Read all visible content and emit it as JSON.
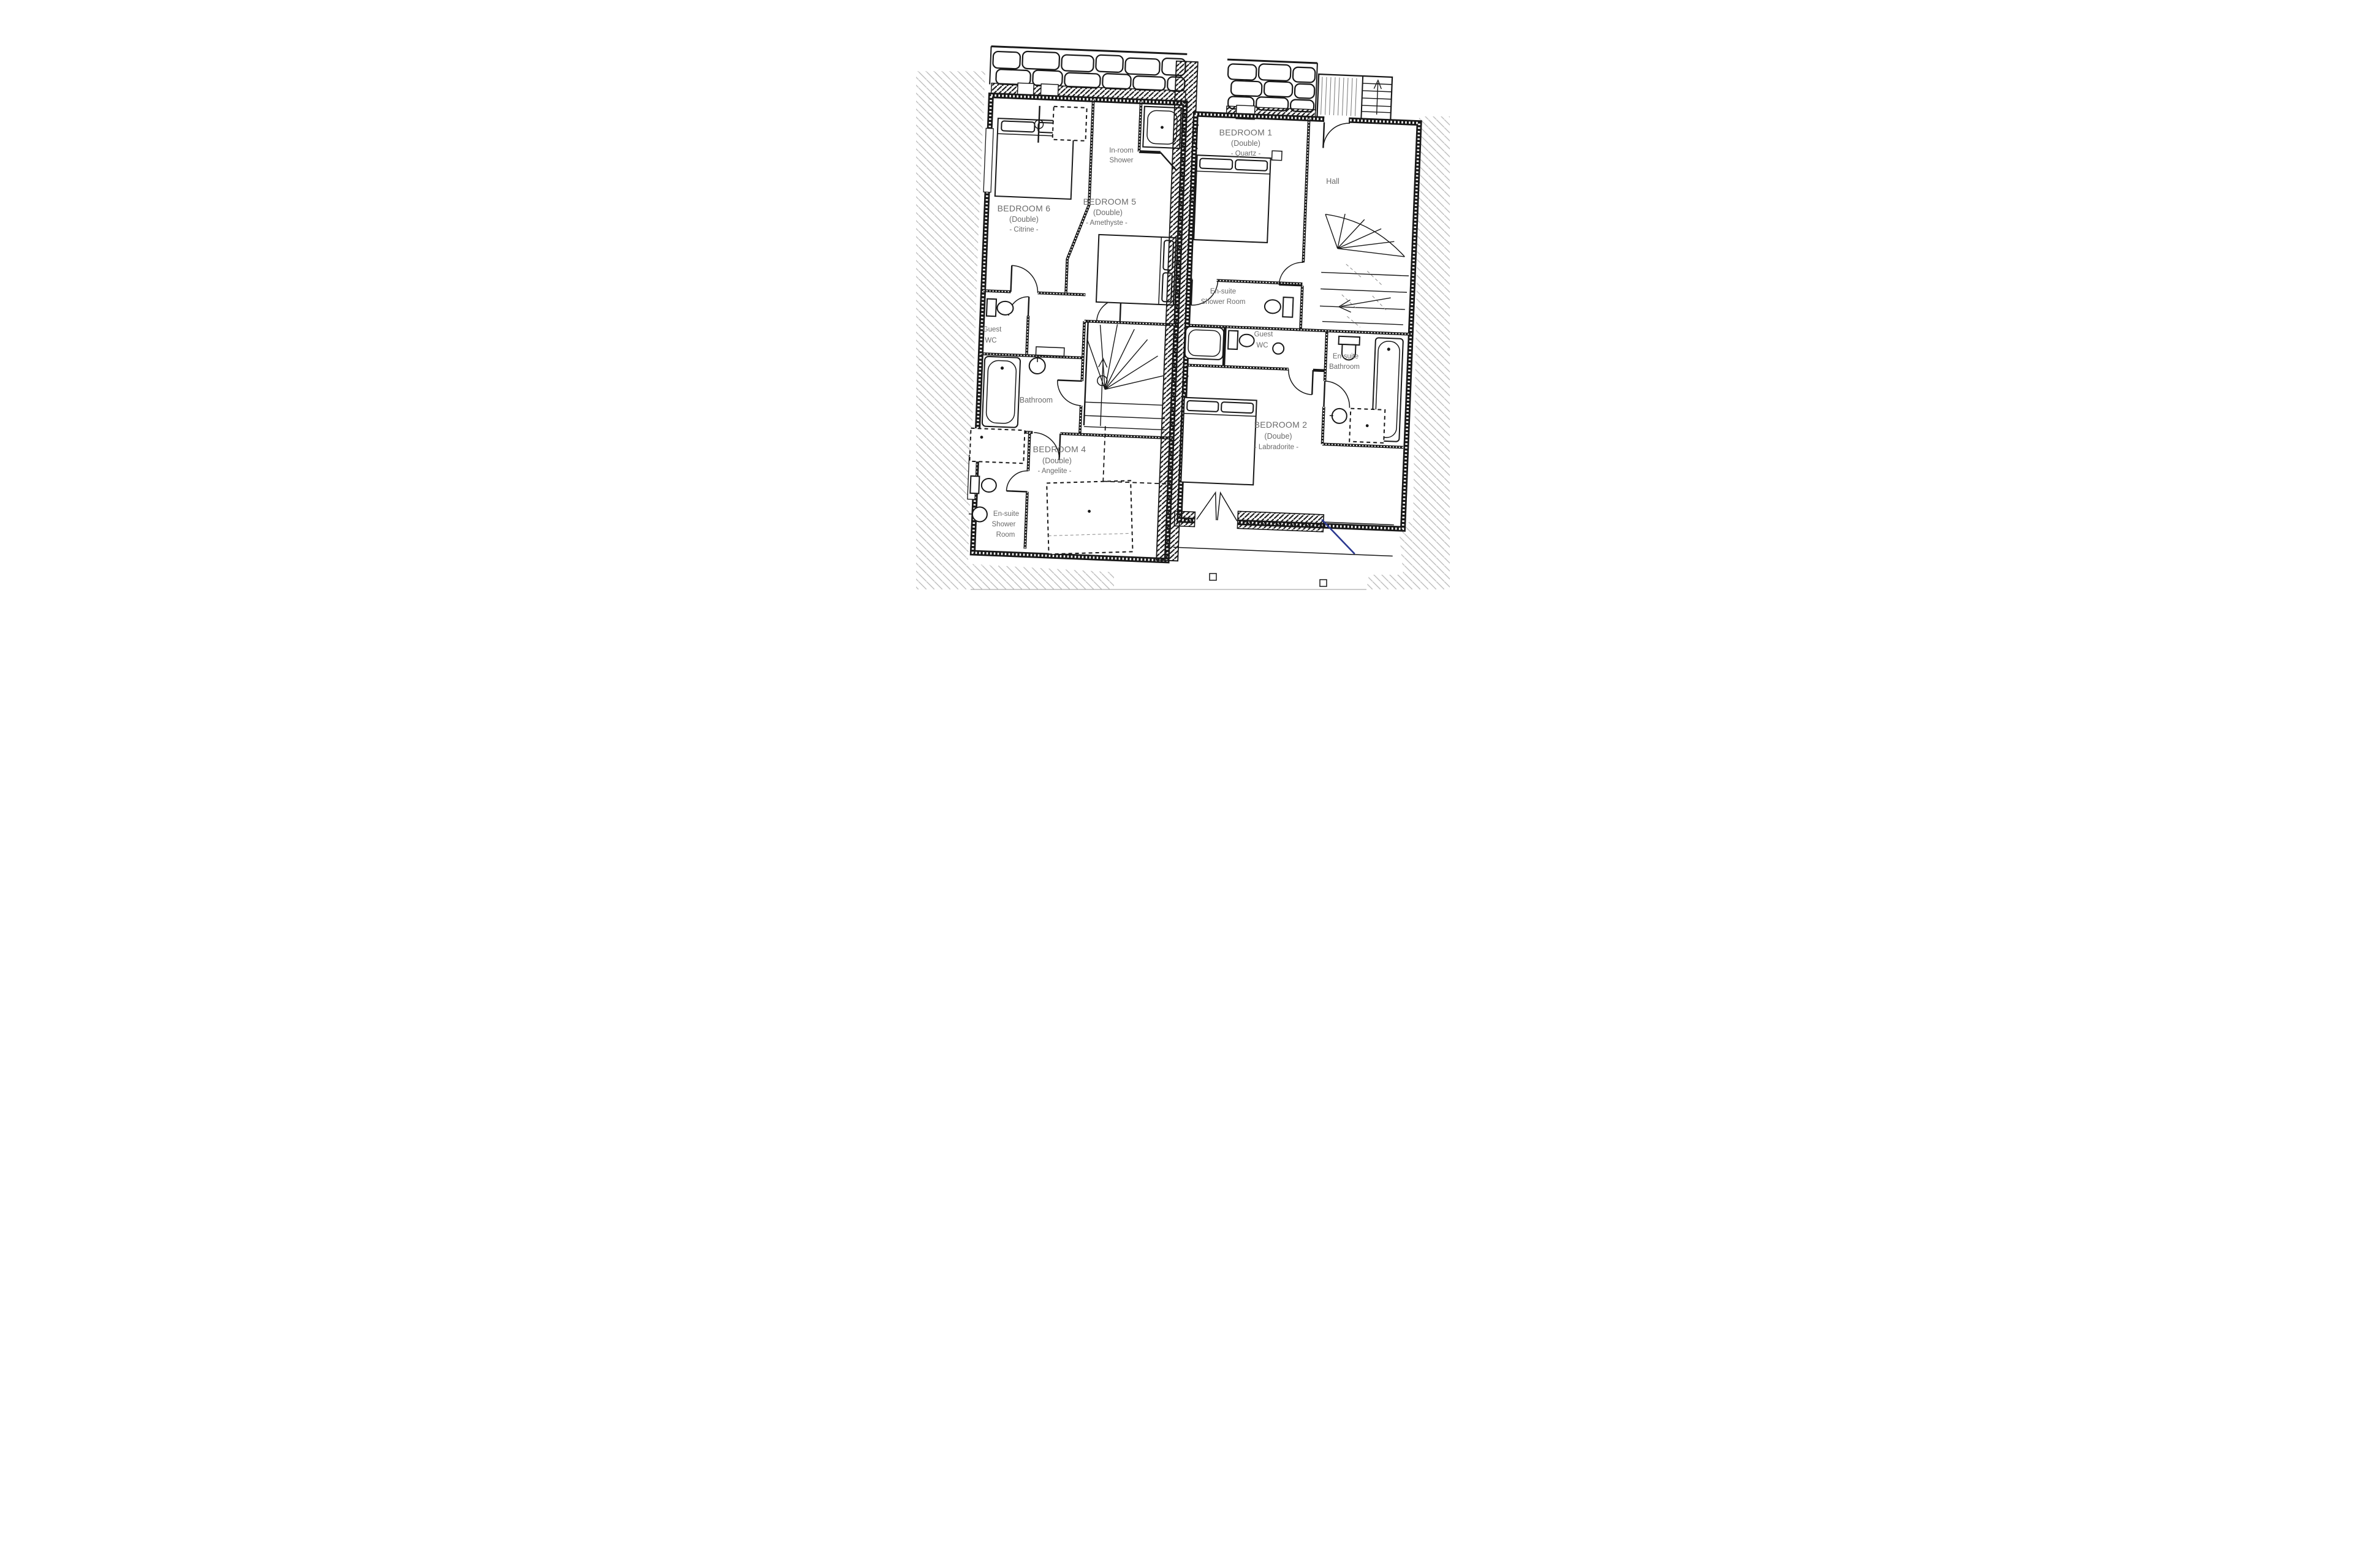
{
  "labels": {
    "bedroom6": {
      "l1": "BEDROOM 6",
      "l2": "(Double)",
      "l3": "- Citrine -"
    },
    "bedroom5": {
      "l1": "BEDROOM 5",
      "l2": "(Double)",
      "l3": "- Amethyste -"
    },
    "inroom_shower": {
      "l1": "In-room",
      "l2": "Shower"
    },
    "bedroom1": {
      "l1": "BEDROOM 1",
      "l2": "(Double)",
      "l3": "- Quartz -"
    },
    "hall": {
      "l1": "Hall"
    },
    "ensuite_shower_mid": {
      "l1": "En-suite",
      "l2": "Shower Room"
    },
    "guest_wc_left": {
      "l1": "Guest",
      "l2": "WC"
    },
    "guest_wc_right": {
      "l1": "Guest",
      "l2": "WC"
    },
    "ensuite_bathroom": {
      "l1": "En-suite",
      "l2": "Bathroom"
    },
    "bathroom": {
      "l1": "Bathroom"
    },
    "bedroom4": {
      "l1": "BEDROOM 4",
      "l2": "(Double)",
      "l3": "- Angelite -"
    },
    "bedroom2": {
      "l1": "BEDROOM 2",
      "l2": "(Doube)",
      "l3": "- Labradorite -"
    },
    "ensuite_shower_bl": {
      "l1": "En-suite",
      "l2": "Shower",
      "l3": "Room"
    }
  },
  "colors": {
    "line": "#181818",
    "label_grey": "#6a6a6a",
    "site_hatch_grey": "#bdbdbd",
    "accent_blue": "#2b3990"
  }
}
